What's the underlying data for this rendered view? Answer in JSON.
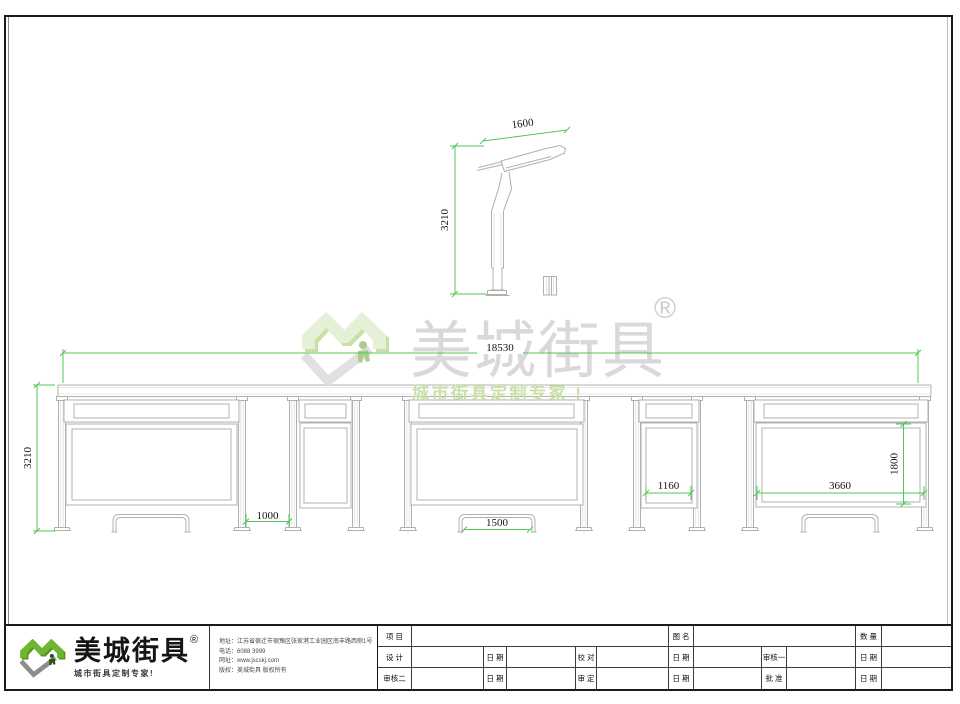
{
  "watermark": {
    "brand": "美城街具",
    "reg": "®",
    "tagline": "城市街具定制专家 !"
  },
  "logo": {
    "brand": "美城街具",
    "reg": "®",
    "tagline": "城市街具定制专家!"
  },
  "company_info": {
    "address": "地址：江苏省宿迁市宿豫区张家港工业园区南丰路西侧1号",
    "phone": "电话：6088 3999",
    "website": "网址：www.jscskj.com",
    "copyright": "版权：美城街具 版权所有"
  },
  "dimensions": {
    "side_pole_width": "1600",
    "side_pole_height": "3210",
    "total_width": "18530",
    "shelter_height": "3210",
    "bay_gap": "1000",
    "bench_width": "1500",
    "small_panel_width": "1160",
    "large_panel_width": "3660",
    "panel_height": "1800"
  },
  "title_block": {
    "table": {
      "row1": [
        "项 目",
        "",
        "图 名",
        "",
        "数 量",
        ""
      ],
      "row2": [
        "设 计",
        "",
        "日 期",
        "",
        "校 对",
        "",
        "日 期",
        "",
        "审核一",
        "",
        "日 期",
        ""
      ],
      "row3": [
        "审核二",
        "",
        "日 期",
        "",
        "审 定",
        "",
        "日 期",
        "",
        "批 准",
        "",
        "日 期",
        ""
      ]
    }
  },
  "colors": {
    "dimension_green": "#52c852",
    "logo_green": "#6eb62f",
    "logo_green_dark": "#55921c",
    "line_gray": "#b0b0b0"
  }
}
